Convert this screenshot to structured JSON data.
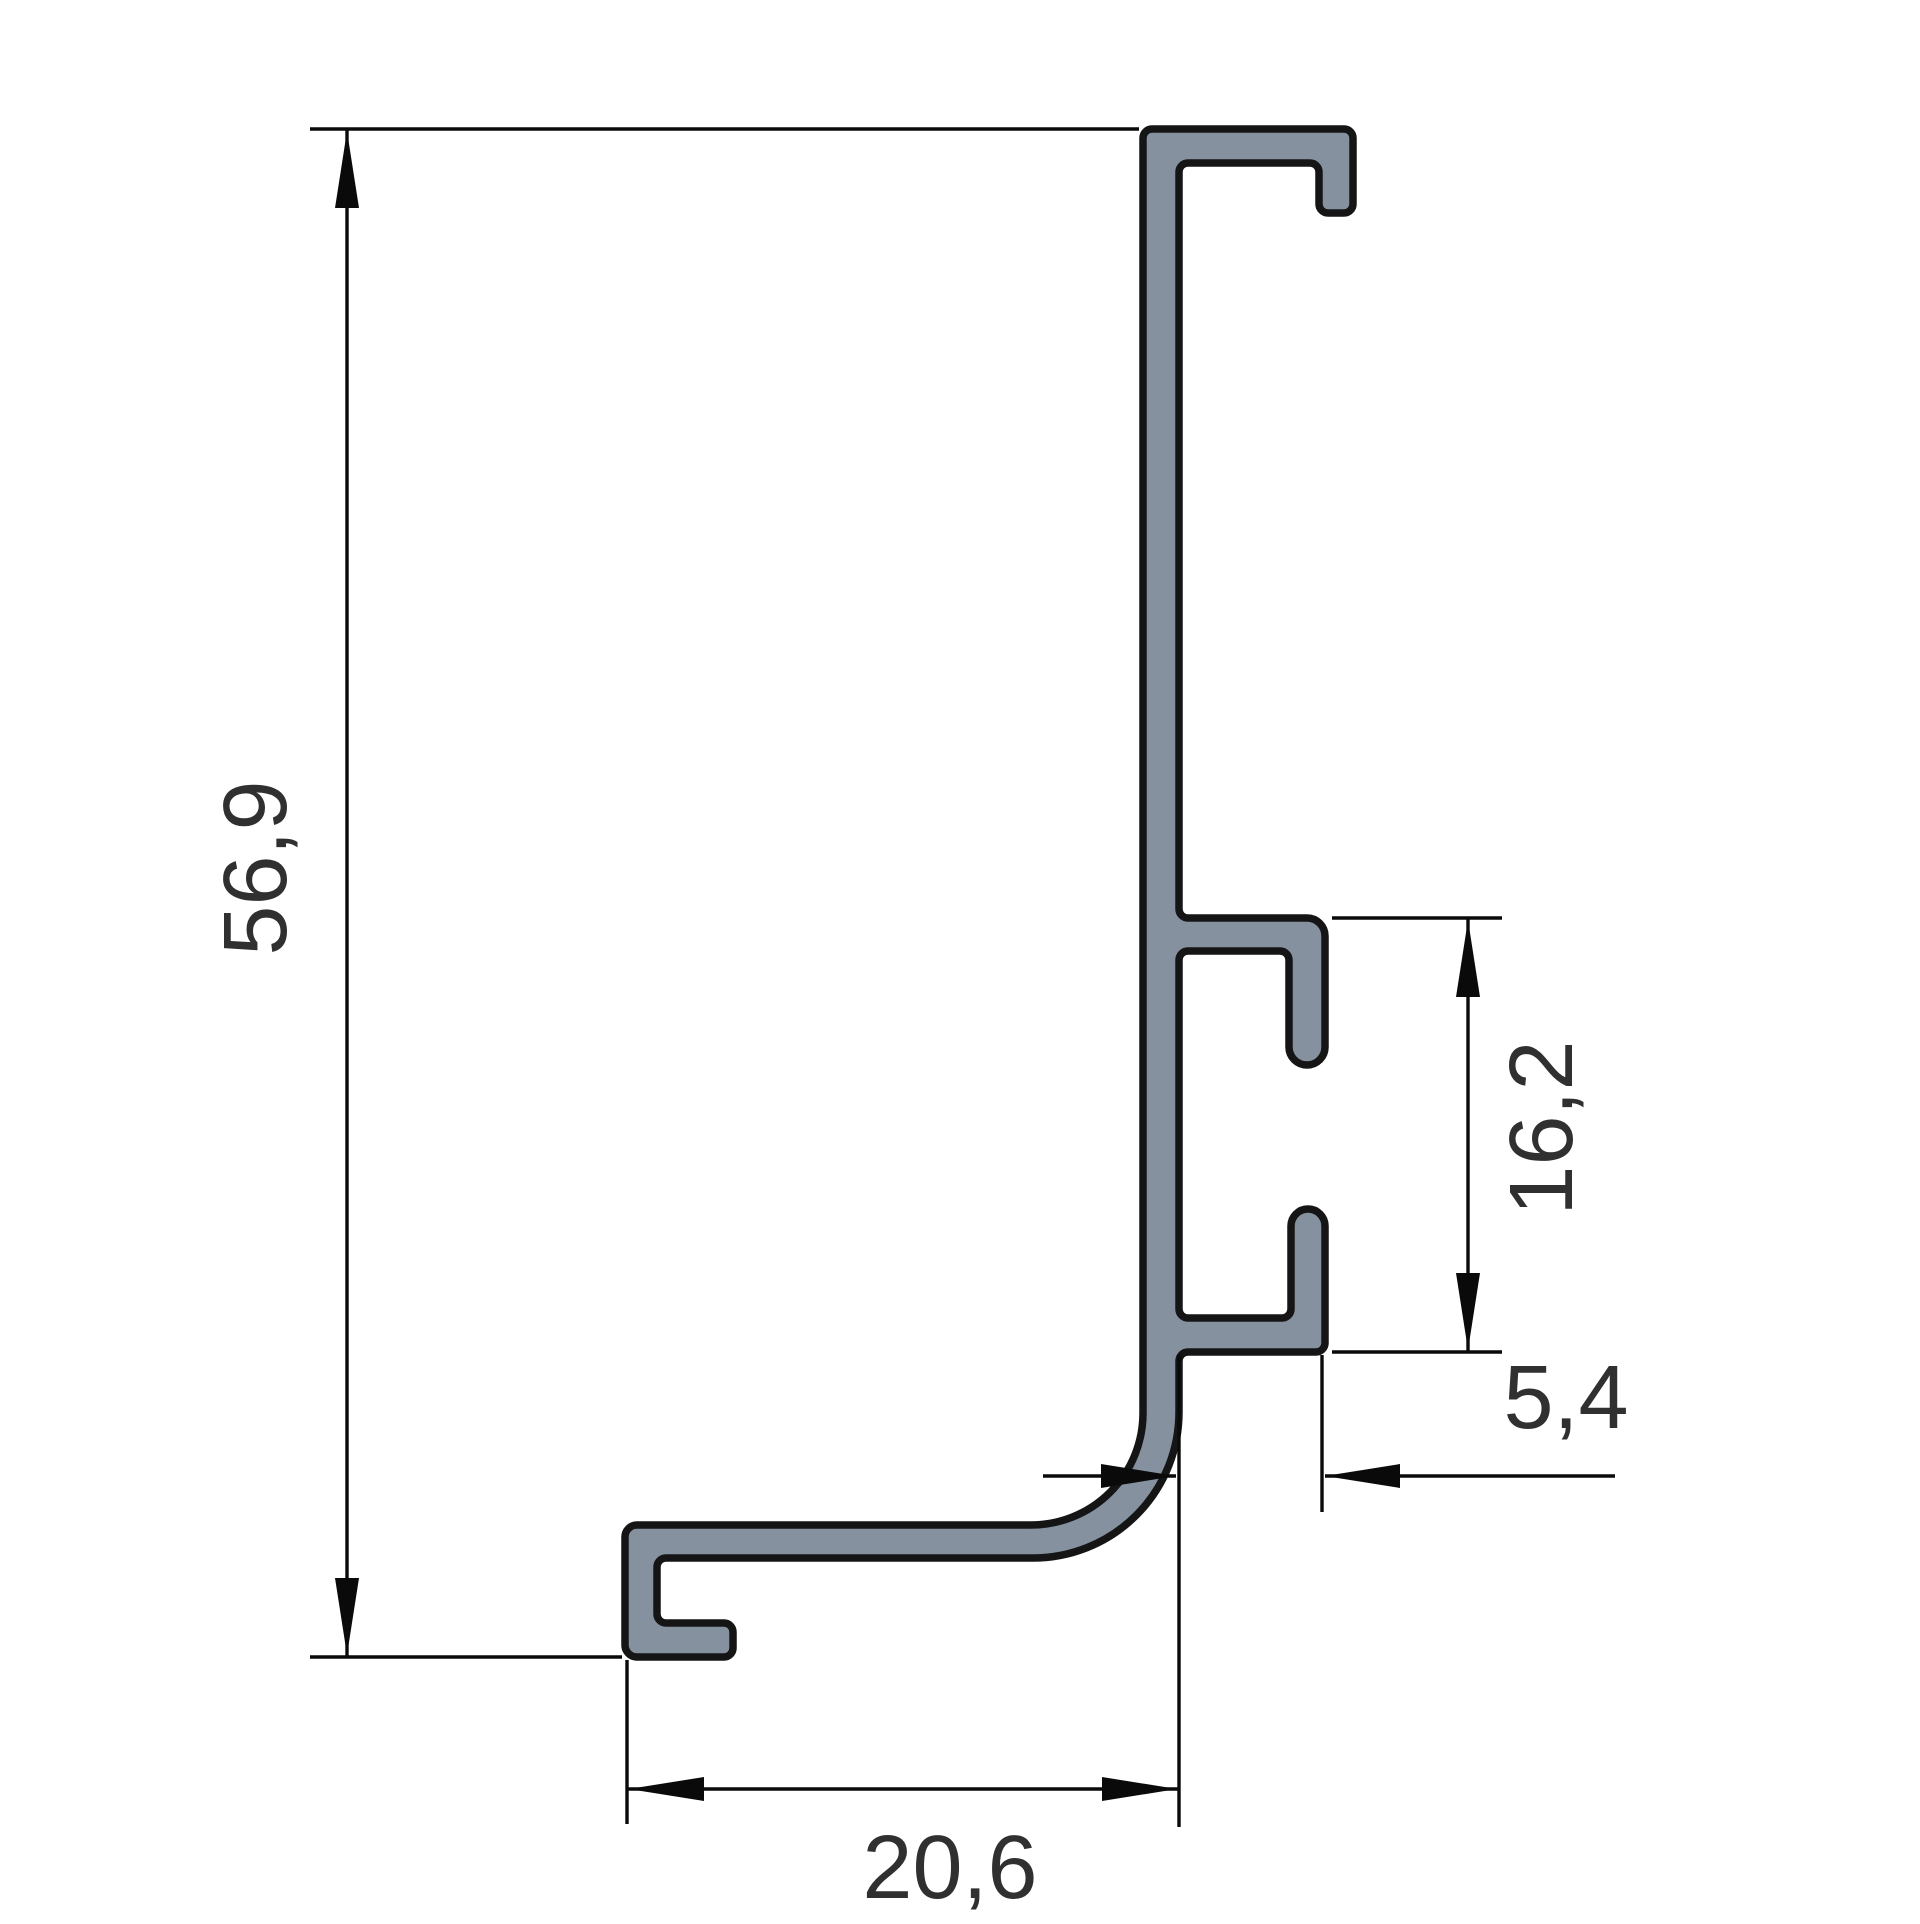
{
  "page": {
    "type": "technical-drawing",
    "background": "#ffffff"
  },
  "drawing": {
    "subject": "aluminum-profile-cross-section",
    "profile_fill": "#8691a0",
    "profile_outline": "#151515",
    "line_color": "#0a0a0a",
    "text_color": "#303030"
  },
  "dimensions": {
    "height": {
      "label": "56,9",
      "orientation": "vertical"
    },
    "slot": {
      "label": "16,2",
      "orientation": "vertical"
    },
    "offset": {
      "label": "5,4",
      "orientation": "horizontal"
    },
    "width": {
      "label": "20,6",
      "orientation": "horizontal"
    }
  }
}
